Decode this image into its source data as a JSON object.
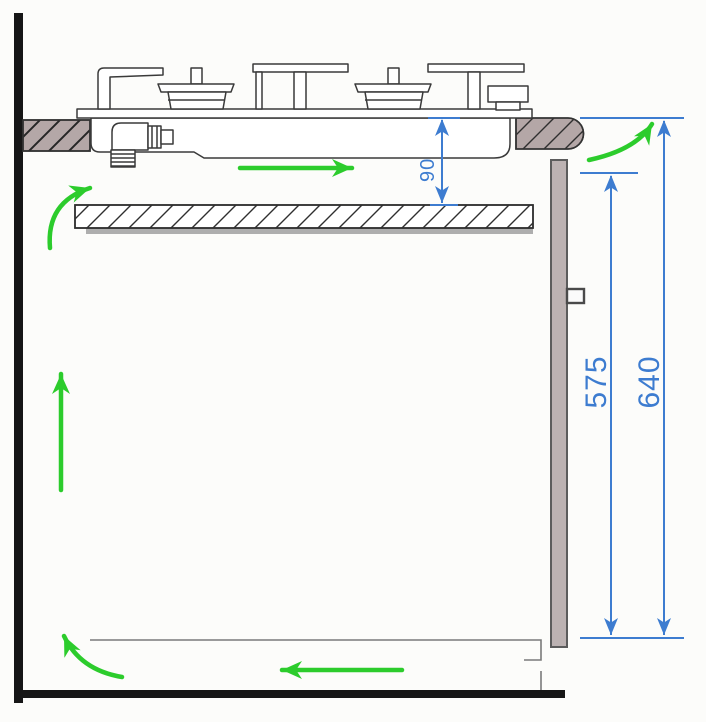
{
  "diagram": {
    "type": "installation-clearance-cross-section",
    "subject": "built-in gas hob ventilation and clearance diagram",
    "dimension_labels": {
      "hob_to_shelf": "90",
      "rear_panel_height": "575",
      "worktop_to_bottom": "640"
    },
    "colors": {
      "dimension_blue": "#3d7cd0",
      "airflow_green": "#2ccc2c",
      "worktop_fill": "#b4a7a7",
      "panel_fill": "#bcb2b2",
      "structure_black": "#161616",
      "line_dark": "#3a3a3a"
    }
  }
}
